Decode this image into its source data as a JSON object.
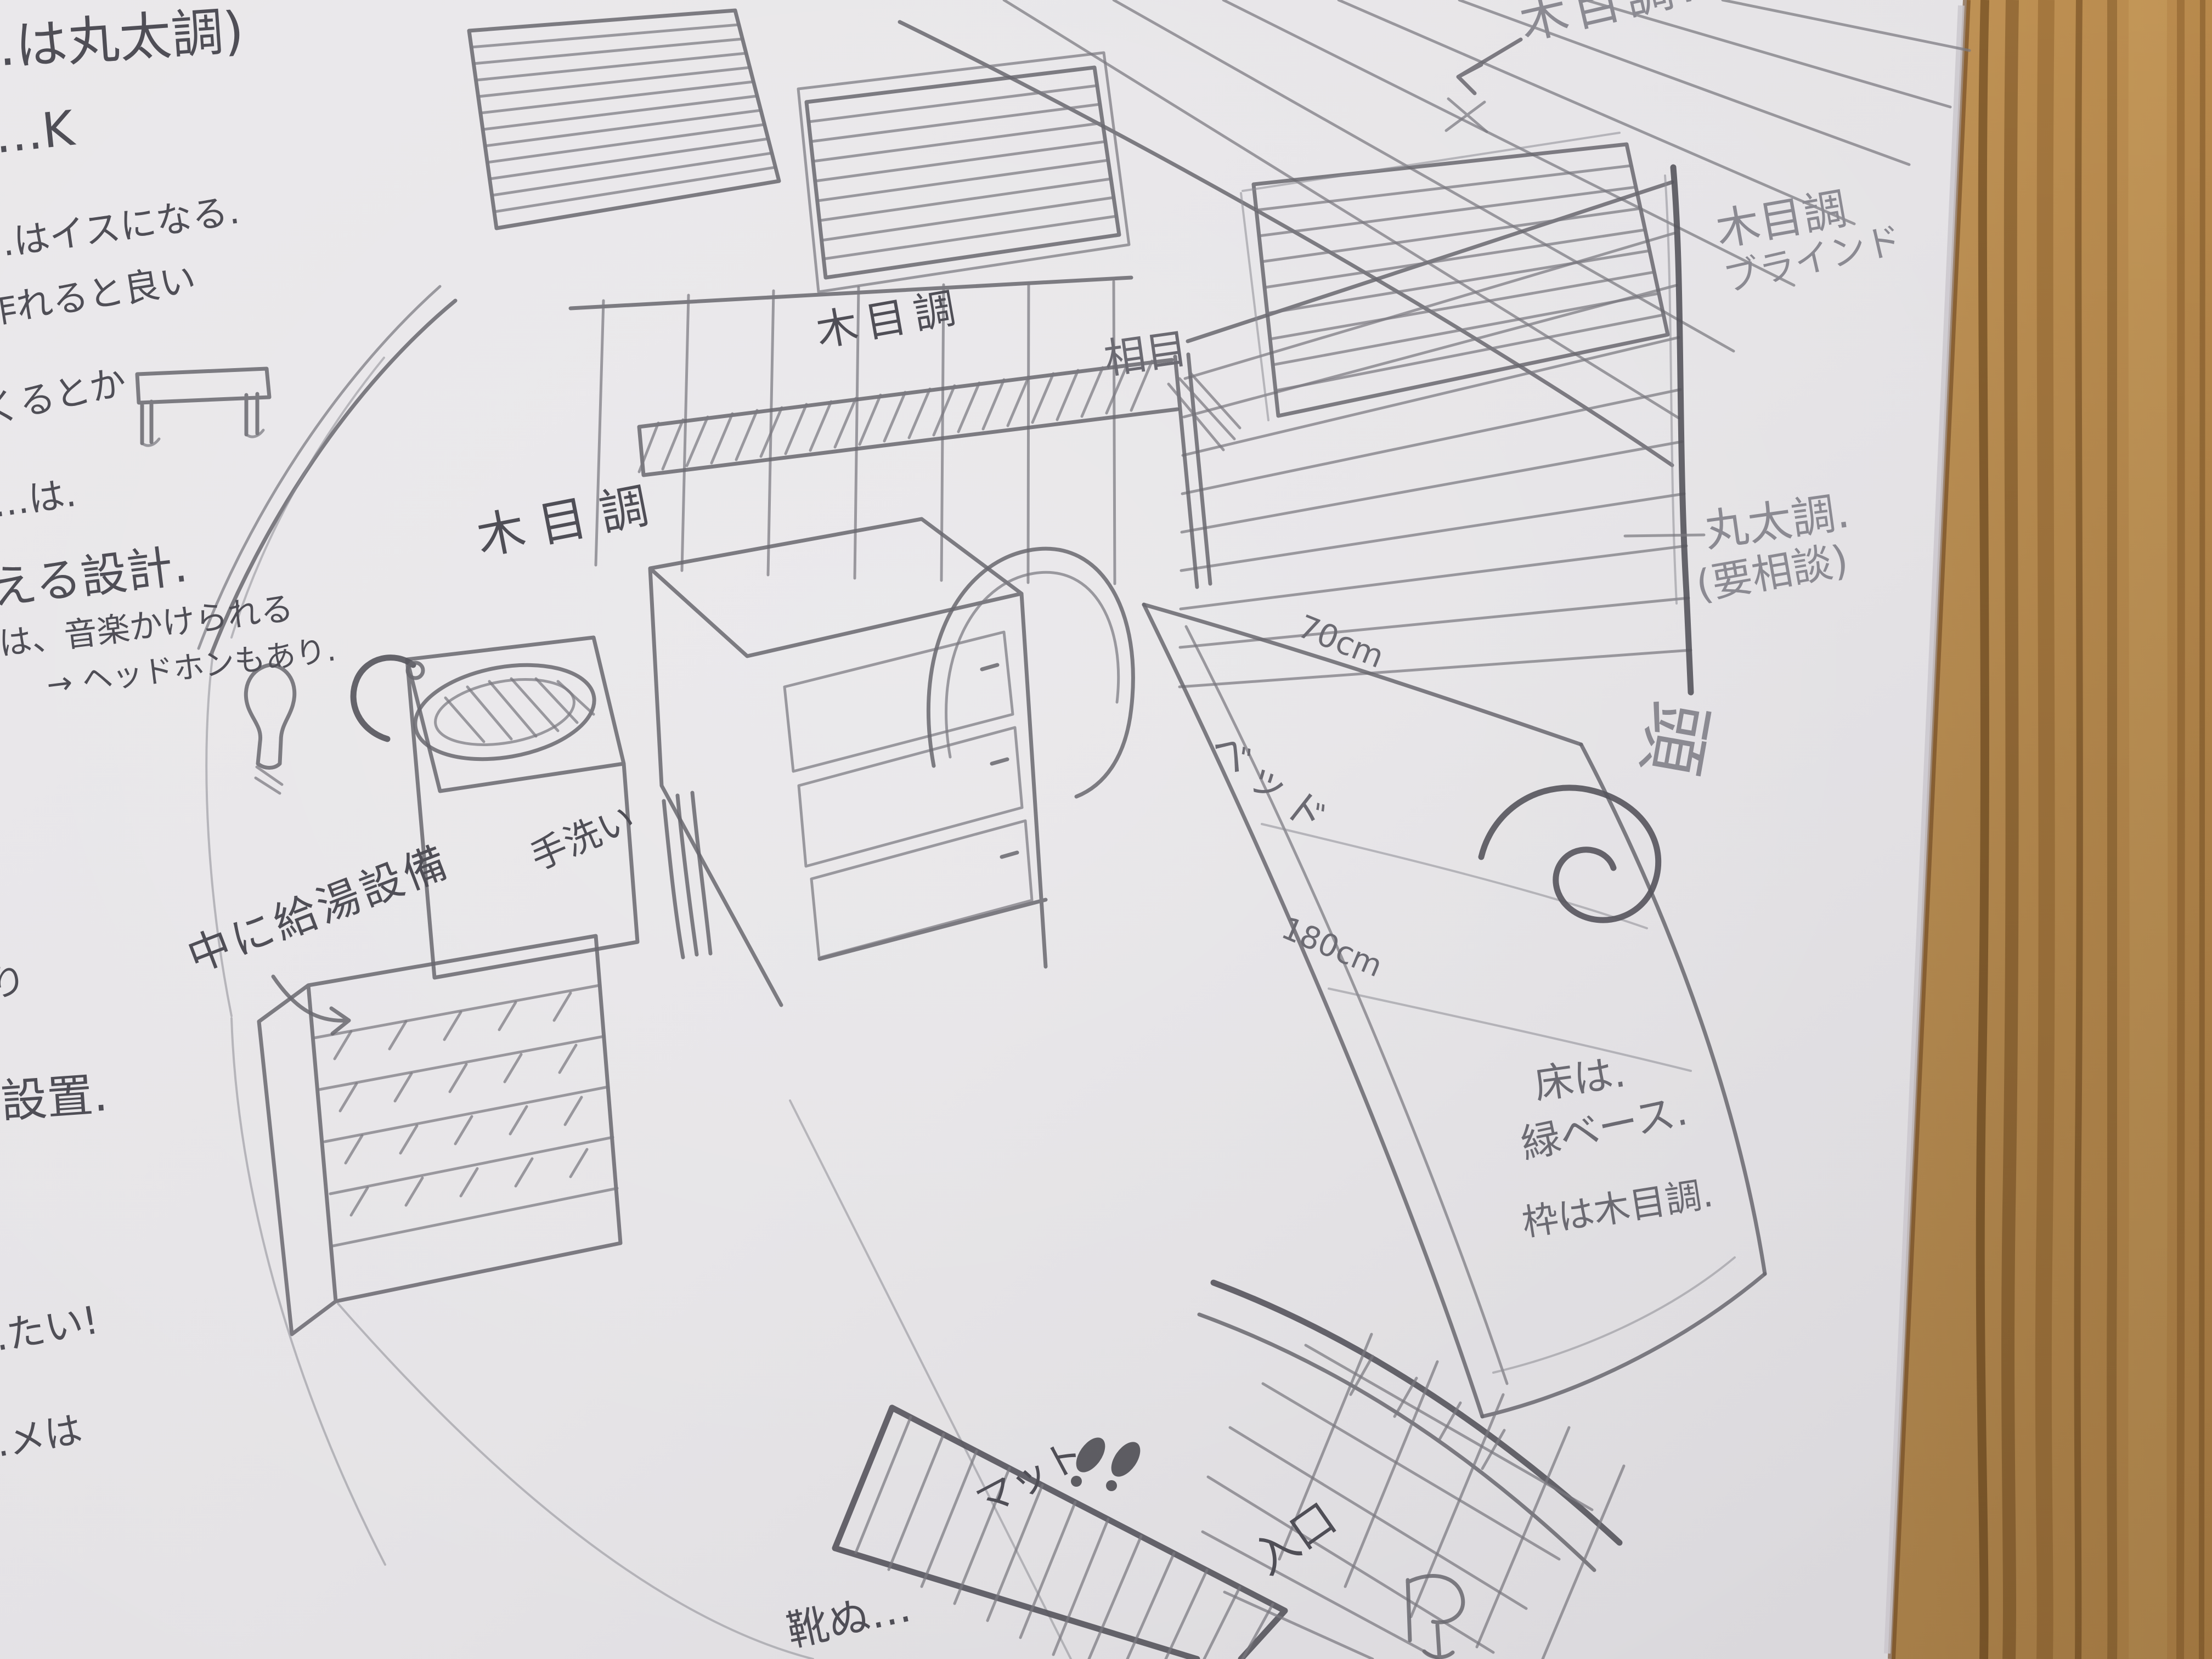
{
  "colors": {
    "pencil": "#6b6a72",
    "pencil_dark": "#4f4e56",
    "pencil_faint": "#8b8a92",
    "paper": "#e4e2e5",
    "wood_table": "#b68449"
  },
  "annotations": {
    "note_log_top": "…は丸太調)",
    "note_ok": "…K",
    "note_chair_1": "…はイスになる.",
    "note_chair_2": "作れると良い",
    "note_kuru": "くるとか",
    "note_ha": "…は.",
    "note_design": "…える設計.",
    "note_music": "…は、音楽かけられる",
    "note_headphone": "→ ヘッドホンもあり.",
    "note_ri": "り",
    "note_setchi": "…設置.",
    "note_tai": "…たい!",
    "note_meha": "…メは",
    "label_mokume_wall": "木目調",
    "label_mokume_cabinet": "木目調",
    "label_aime_rail": "相目",
    "label_mokume_topright": "木目調.",
    "label_blind_line1": "木目調",
    "label_blind_line2": "ブラインド",
    "label_log_style": "丸太調.",
    "label_log_note": "(要相談)",
    "label_head": "頭",
    "label_width_70cm": "70cm",
    "label_bed": "ベッド",
    "label_length_180cm": "180cm",
    "label_handwash": "手洗い",
    "label_hot_water": "中に給湯設備",
    "label_floor_1": "床は.",
    "label_floor_2": "緑ベース.",
    "label_floor_3": "枠は木目調.",
    "label_mat": "マット",
    "label_entrance": "入口",
    "note_shoes": "靴ぬ…"
  }
}
